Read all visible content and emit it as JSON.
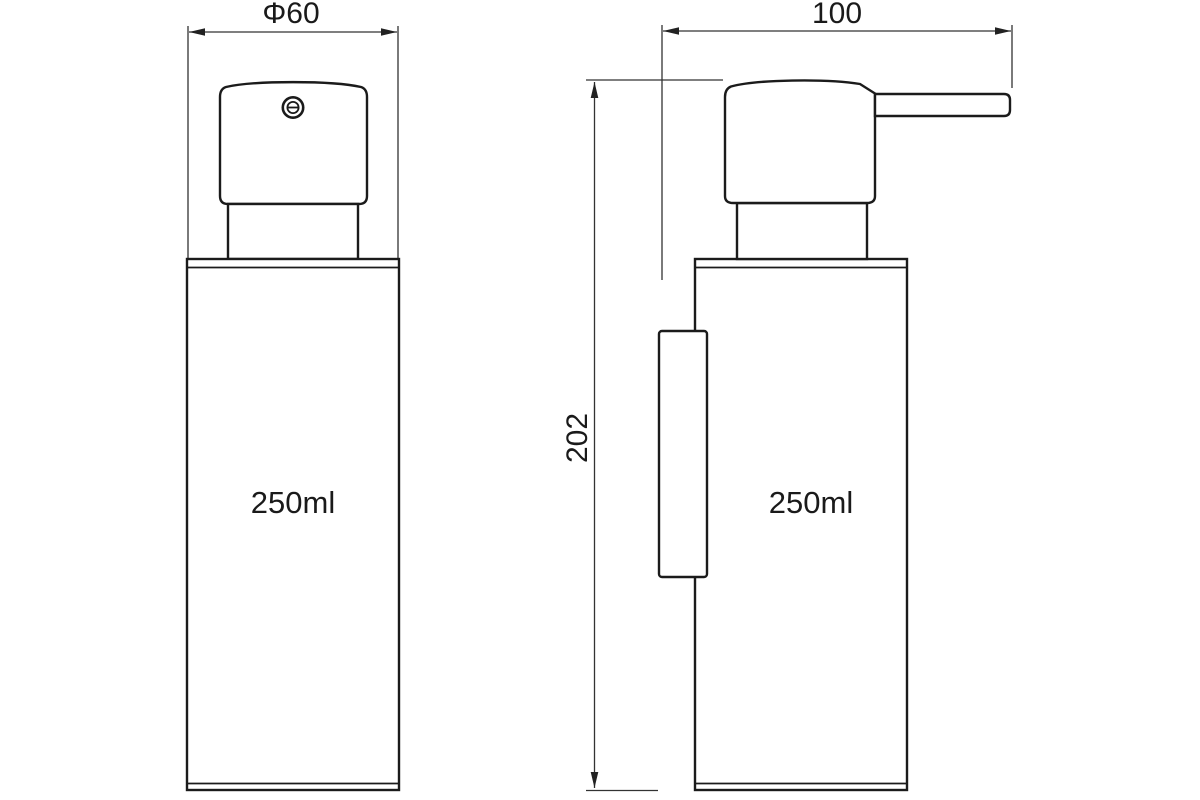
{
  "drawing": {
    "background_color": "#ffffff",
    "line_color": "#1b1b1b",
    "front_view": {
      "diameter_label": "Φ60",
      "capacity_label": "250ml"
    },
    "side_view": {
      "width_label": "100",
      "height_label": "202",
      "capacity_label": "250ml"
    }
  }
}
